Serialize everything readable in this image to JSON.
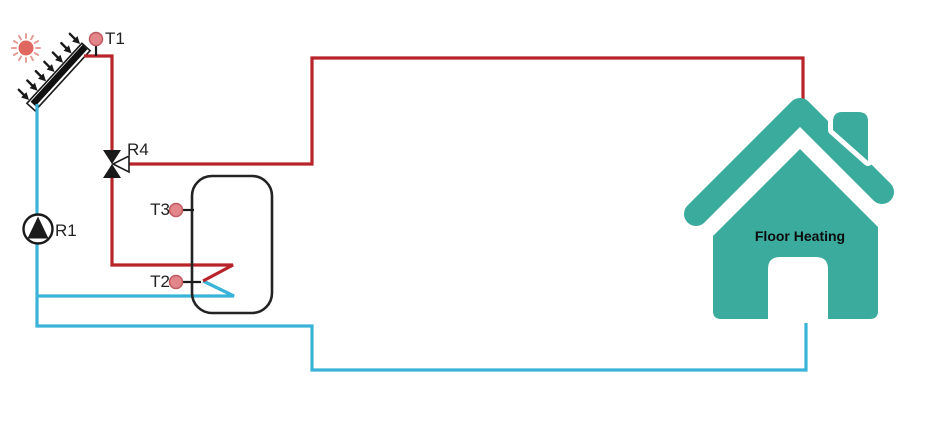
{
  "labels": {
    "t1": "T1",
    "r4": "R4",
    "r1": "R1",
    "t3": "T3",
    "t2": "T2",
    "floor_heating": "Floor Heating"
  },
  "colors": {
    "hot_pipe": "#b9242a",
    "cold_pipe": "#3ab3d9",
    "house_teal": "#3aab9d",
    "sensor_dot_fill": "#e2868a",
    "sensor_dot_stroke": "#bf5a60",
    "sun_core": "#e06660",
    "sun_rays": "#e69e97",
    "component_black": "#1a1a1a"
  },
  "components": [
    {
      "id": "sun",
      "icon": "sun-icon"
    },
    {
      "id": "collector",
      "icon": "solar-collector-icon"
    },
    {
      "id": "t1-sensor",
      "icon": "sensor-dot-icon",
      "label": "T1"
    },
    {
      "id": "r4-valve",
      "icon": "three-way-valve-icon",
      "label": "R4"
    },
    {
      "id": "r1-pump",
      "icon": "pump-icon",
      "label": "R1"
    },
    {
      "id": "tank",
      "icon": "storage-tank-icon"
    },
    {
      "id": "t3-sensor",
      "icon": "sensor-dot-icon",
      "label": "T3"
    },
    {
      "id": "t2-sensor",
      "icon": "sensor-dot-icon",
      "label": "T2"
    },
    {
      "id": "house",
      "icon": "house-icon",
      "label": "Floor Heating"
    }
  ]
}
